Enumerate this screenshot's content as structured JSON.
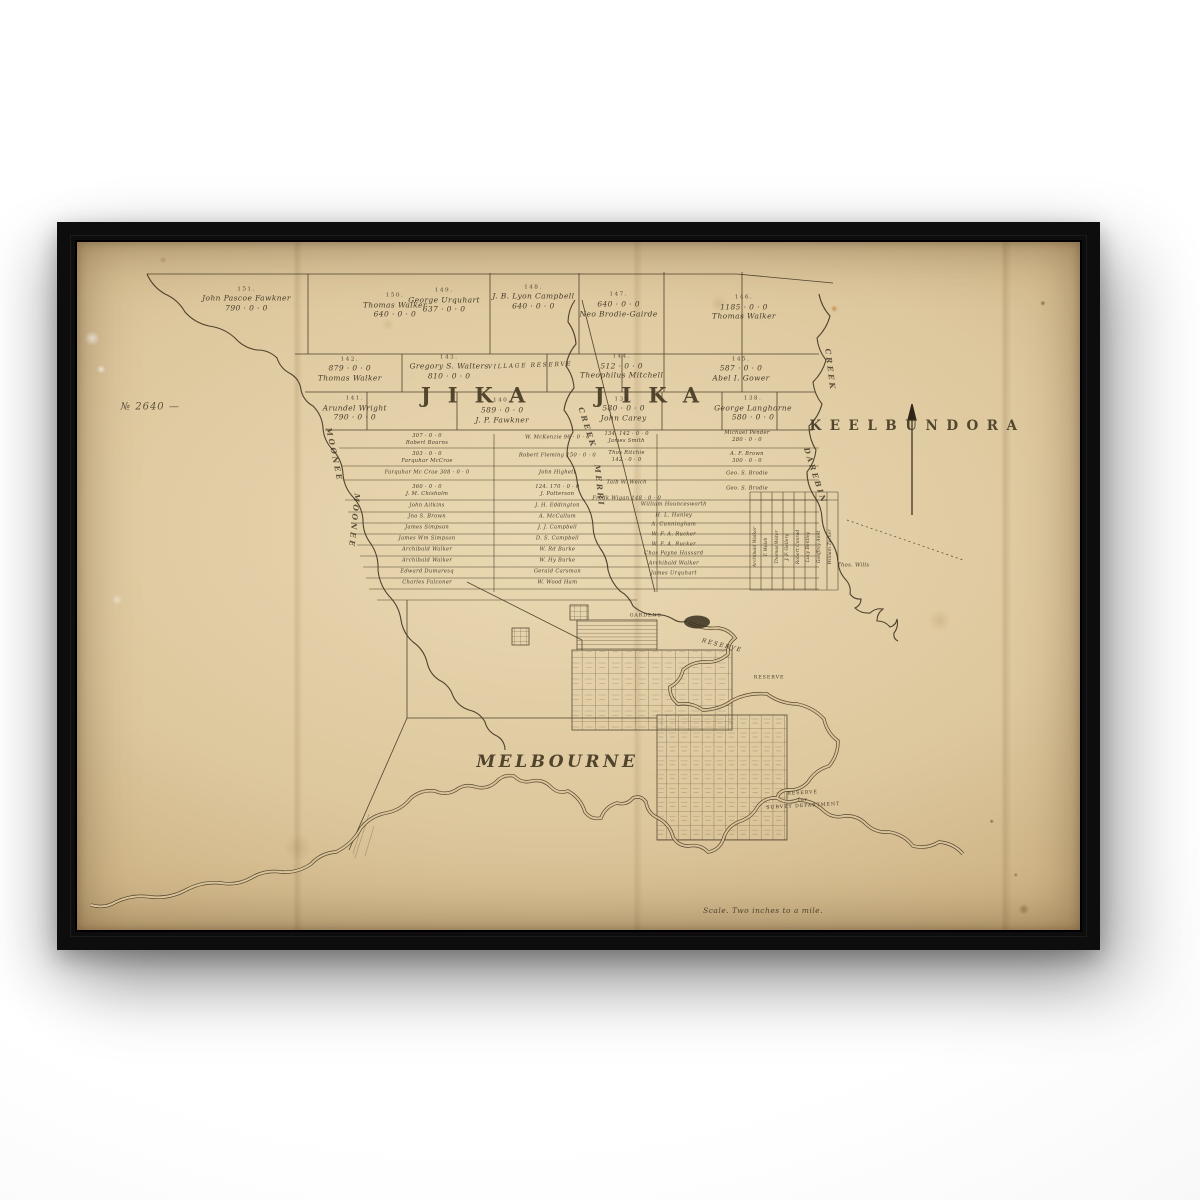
{
  "scene": {
    "background_color": "#ffffff",
    "frame_color": "#0d0d0d",
    "paper_color": "#dcc79d",
    "ink_color": "#3a3120"
  },
  "map": {
    "map_number": "№ 2640 —",
    "parish_title": "JIKA JIKA",
    "adjacent_parish": "KEELBUNDORA",
    "town_label": "MELBOURNE",
    "scale_note": "Scale. Two inches to a mile.",
    "creek_names": [
      "MOONEE MOONEE",
      "MERRI CREEK",
      "DAREBIN CREEK"
    ],
    "labels": [
      {
        "name": "map-number",
        "cls": "manu",
        "x": 7.3,
        "y": 24.0,
        "lines": [
          "№ 2640 —"
        ]
      },
      {
        "name": "parish-title",
        "cls": "parish",
        "x": 49.0,
        "y": 22.3,
        "lines": [
          "JIKA JIKA"
        ]
      },
      {
        "name": "adjacent-parish",
        "cls": "region",
        "x": 83.8,
        "y": 26.9,
        "lines": [
          "KEELBUNDORA"
        ]
      },
      {
        "name": "town-label",
        "cls": "town",
        "x": 47.9,
        "y": 75.6,
        "lines": [
          "MELBOURNE"
        ]
      },
      {
        "name": "scale-note",
        "cls": "script",
        "x": 68.4,
        "y": 97.2,
        "lines": [
          "Scale. Two inches to a mile."
        ]
      },
      {
        "name": "lot-151",
        "cls": "parcel",
        "x": 16.9,
        "y": 8.4,
        "lines": [
          "151.",
          "John Pascoe Fawkner",
          "790 · 0 · 0"
        ]
      },
      {
        "name": "lot-150",
        "cls": "parcel",
        "x": 31.7,
        "y": 9.3,
        "lines": [
          "150.",
          "Thomas Walker",
          "640 · 0 · 0"
        ]
      },
      {
        "name": "lot-149",
        "cls": "parcel",
        "x": 36.6,
        "y": 8.6,
        "lines": [
          "149.",
          "George Urquhart",
          "637 · 0 · 0"
        ]
      },
      {
        "name": "lot-148",
        "cls": "parcel",
        "x": 45.5,
        "y": 8.1,
        "lines": [
          "148.",
          "J. B. Lyon Campbell",
          "640 · 0 · 0"
        ]
      },
      {
        "name": "lot-147",
        "cls": "parcel",
        "x": 54.0,
        "y": 9.2,
        "lines": [
          "147.",
          "640 · 0 · 0",
          "Neo Brodie-Gairde"
        ]
      },
      {
        "name": "lot-146",
        "cls": "parcel",
        "x": 66.5,
        "y": 9.6,
        "lines": [
          "146.",
          "1185 · 0 · 0",
          "Thomas Walker"
        ]
      },
      {
        "name": "lot-142",
        "cls": "parcel",
        "x": 27.2,
        "y": 18.6,
        "lines": [
          "142.",
          "879 · 0 · 0",
          "Thomas Walker"
        ]
      },
      {
        "name": "lot-143",
        "cls": "parcel",
        "x": 37.1,
        "y": 18.3,
        "lines": [
          "143.",
          "Gregory S. Walters",
          "810 · 0 · 0"
        ]
      },
      {
        "name": "village-reserve",
        "cls": "note",
        "x": 45.2,
        "y": 18.0,
        "rot": -2,
        "lines": [
          "VILLAGE RESERVE"
        ]
      },
      {
        "name": "lot-144",
        "cls": "parcel",
        "x": 54.3,
        "y": 18.2,
        "lines": [
          "144.",
          "512 · 0 · 0",
          "Theophilus Mitchell"
        ]
      },
      {
        "name": "lot-145",
        "cls": "parcel",
        "x": 66.2,
        "y": 18.6,
        "lines": [
          "145.",
          "587 · 0 · 0",
          "Abel I. Gower"
        ]
      },
      {
        "name": "lot-141",
        "cls": "parcel",
        "x": 27.7,
        "y": 24.3,
        "lines": [
          "141.",
          "Arundel Wright",
          "790 · 0 · 0"
        ]
      },
      {
        "name": "lot-140",
        "cls": "parcel",
        "x": 42.4,
        "y": 24.6,
        "lines": [
          "140.",
          "589 · 0 · 0",
          "J. P. Fawkner"
        ]
      },
      {
        "name": "lot-139",
        "cls": "parcel",
        "x": 54.5,
        "y": 24.4,
        "lines": [
          "139.",
          "580 · 0 · 0",
          "John Carey"
        ]
      },
      {
        "name": "lot-138",
        "cls": "parcel",
        "x": 67.4,
        "y": 24.3,
        "lines": [
          "138.",
          "George Langhorne",
          "580 · 0 · 0"
        ]
      },
      {
        "name": "strip-parcel",
        "cls": "strip",
        "x": 34.9,
        "y": 28.8,
        "lines": [
          "307 · 0 · 0",
          "Robert Bourns"
        ]
      },
      {
        "name": "strip-parcel",
        "cls": "strip",
        "x": 34.9,
        "y": 31.4,
        "lines": [
          "303 · 0 · 0",
          "Farquhar McCrae"
        ]
      },
      {
        "name": "strip-parcel",
        "cls": "strip",
        "x": 34.9,
        "y": 33.6,
        "lines": [
          "Farquhar Mc Crae  308 · 0 · 0"
        ]
      },
      {
        "name": "strip-parcel",
        "cls": "strip",
        "x": 34.9,
        "y": 36.2,
        "lines": [
          "360 · 0 · 0",
          "J. M. Chisholm"
        ]
      },
      {
        "name": "strip-parcel",
        "cls": "strip",
        "x": 34.9,
        "y": 38.4,
        "lines": [
          "John Aitkins"
        ]
      },
      {
        "name": "strip-parcel",
        "cls": "strip",
        "x": 34.9,
        "y": 40.0,
        "lines": [
          "Jno S. Brown"
        ]
      },
      {
        "name": "strip-parcel",
        "cls": "strip",
        "x": 34.9,
        "y": 41.6,
        "lines": [
          "James Simpson"
        ]
      },
      {
        "name": "strip-parcel",
        "cls": "strip",
        "x": 34.9,
        "y": 43.2,
        "lines": [
          "James Wm Simpson"
        ]
      },
      {
        "name": "strip-parcel",
        "cls": "strip",
        "x": 34.9,
        "y": 44.8,
        "lines": [
          "Archibald Walker"
        ]
      },
      {
        "name": "strip-parcel",
        "cls": "strip",
        "x": 34.9,
        "y": 46.4,
        "lines": [
          "Archibald Walker"
        ]
      },
      {
        "name": "strip-parcel",
        "cls": "strip",
        "x": 34.9,
        "y": 48.0,
        "lines": [
          "Edward Dumaresq"
        ]
      },
      {
        "name": "strip-parcel",
        "cls": "strip",
        "x": 34.9,
        "y": 49.6,
        "lines": [
          "Charles Falconer"
        ]
      },
      {
        "name": "strip-parcel",
        "cls": "strip",
        "x": 47.9,
        "y": 28.5,
        "lines": [
          "W. McKenzie  96 · 0 · 0"
        ]
      },
      {
        "name": "strip-parcel",
        "cls": "strip",
        "x": 47.9,
        "y": 31.1,
        "lines": [
          "Robert Fleming  150 · 0 · 0"
        ]
      },
      {
        "name": "strip-parcel",
        "cls": "strip",
        "x": 47.9,
        "y": 33.6,
        "lines": [
          "John Highett"
        ]
      },
      {
        "name": "strip-parcel",
        "cls": "strip",
        "x": 47.9,
        "y": 36.2,
        "lines": [
          "124.  170 · 0 · 0",
          "J. Patterson"
        ]
      },
      {
        "name": "strip-parcel",
        "cls": "strip",
        "x": 47.9,
        "y": 38.4,
        "lines": [
          "J. H. Eddington"
        ]
      },
      {
        "name": "strip-parcel",
        "cls": "strip",
        "x": 47.9,
        "y": 40.0,
        "lines": [
          "A. McCallum"
        ]
      },
      {
        "name": "strip-parcel",
        "cls": "strip",
        "x": 47.9,
        "y": 41.6,
        "lines": [
          "J. J. Campbell"
        ]
      },
      {
        "name": "strip-parcel",
        "cls": "strip",
        "x": 47.9,
        "y": 43.2,
        "lines": [
          "D. S. Campbell"
        ]
      },
      {
        "name": "strip-parcel",
        "cls": "strip",
        "x": 47.9,
        "y": 44.8,
        "lines": [
          "W. Rd Burke"
        ]
      },
      {
        "name": "strip-parcel",
        "cls": "strip",
        "x": 47.9,
        "y": 46.4,
        "lines": [
          "W. Hy Burke"
        ]
      },
      {
        "name": "strip-parcel",
        "cls": "strip",
        "x": 47.9,
        "y": 48.0,
        "lines": [
          "Gerald Carsman"
        ]
      },
      {
        "name": "strip-parcel",
        "cls": "strip",
        "x": 47.9,
        "y": 49.6,
        "lines": [
          "W. Wood Ham"
        ]
      },
      {
        "name": "strip-parcel",
        "cls": "strip",
        "x": 54.8,
        "y": 28.5,
        "lines": [
          "134.  142 · 0 · 0",
          "James Smith"
        ]
      },
      {
        "name": "strip-parcel",
        "cls": "strip",
        "x": 54.8,
        "y": 31.2,
        "lines": [
          "Thos Ritchie",
          "142 · 0 · 0"
        ]
      },
      {
        "name": "strip-parcel",
        "cls": "strip",
        "x": 54.8,
        "y": 35.0,
        "lines": [
          "Talb W. Welch"
        ]
      },
      {
        "name": "strip-parcel",
        "cls": "strip",
        "x": 54.8,
        "y": 37.3,
        "lines": [
          "Fredk Wigan  148 · 0 · 0"
        ]
      },
      {
        "name": "strip-parcel",
        "cls": "strip",
        "x": 59.5,
        "y": 38.2,
        "lines": [
          "William Houncesworth"
        ]
      },
      {
        "name": "strip-parcel",
        "cls": "strip",
        "x": 59.5,
        "y": 39.8,
        "lines": [
          "H. L. Hanley"
        ]
      },
      {
        "name": "strip-parcel",
        "cls": "strip",
        "x": 59.5,
        "y": 41.2,
        "lines": [
          "A. Cunningham"
        ]
      },
      {
        "name": "strip-parcel",
        "cls": "strip",
        "x": 59.5,
        "y": 42.6,
        "lines": [
          "W. F. A. Rucker"
        ]
      },
      {
        "name": "strip-parcel",
        "cls": "strip",
        "x": 59.5,
        "y": 44.0,
        "lines": [
          "W. F. A. Rucker"
        ]
      },
      {
        "name": "strip-parcel",
        "cls": "strip",
        "x": 59.5,
        "y": 45.4,
        "lines": [
          "Chas Payne Hassard"
        ]
      },
      {
        "name": "strip-parcel",
        "cls": "strip",
        "x": 59.5,
        "y": 46.8,
        "lines": [
          "Archibald Walker"
        ]
      },
      {
        "name": "strip-parcel",
        "cls": "strip",
        "x": 59.5,
        "y": 48.2,
        "lines": [
          "James Urquhart"
        ]
      },
      {
        "name": "strip-parcel",
        "cls": "strip",
        "x": 66.8,
        "y": 28.3,
        "lines": [
          "Michael Pender",
          "280 · 0 · 0"
        ]
      },
      {
        "name": "strip-parcel",
        "cls": "strip",
        "x": 66.8,
        "y": 31.4,
        "lines": [
          "A. F. Brown",
          "300 · 0 · 0"
        ]
      },
      {
        "name": "strip-parcel",
        "cls": "strip",
        "x": 66.8,
        "y": 33.7,
        "lines": [
          "Geo. S. Brodie"
        ]
      },
      {
        "name": "strip-parcel",
        "cls": "strip",
        "x": 66.8,
        "y": 35.9,
        "lines": [
          "Geo. S. Brodie"
        ]
      },
      {
        "name": "strip-parcel",
        "cls": "vstrip",
        "x": 67.7,
        "y": 44.3,
        "rot": -90,
        "lines": [
          "Archibald Walker"
        ]
      },
      {
        "name": "strip-parcel",
        "cls": "vstrip",
        "x": 68.8,
        "y": 44.3,
        "rot": -90,
        "lines": [
          "T. Walsh"
        ]
      },
      {
        "name": "strip-parcel",
        "cls": "vstrip",
        "x": 69.9,
        "y": 44.3,
        "rot": -90,
        "lines": [
          "Thomas Water"
        ]
      },
      {
        "name": "strip-parcel",
        "cls": "vstrip",
        "x": 70.9,
        "y": 44.3,
        "rot": -90,
        "lines": [
          "J. F. Gellery"
        ]
      },
      {
        "name": "strip-parcel",
        "cls": "vstrip",
        "x": 72.0,
        "y": 44.3,
        "rot": -90,
        "lines": [
          "Robert Conrad"
        ]
      },
      {
        "name": "strip-parcel",
        "cls": "vstrip",
        "x": 73.0,
        "y": 44.3,
        "rot": -90,
        "lines": [
          "Lucy Bentley"
        ]
      },
      {
        "name": "strip-parcel",
        "cls": "vstrip",
        "x": 74.1,
        "y": 44.3,
        "rot": -90,
        "lines": [
          "Geoffrey Amit"
        ]
      },
      {
        "name": "strip-parcel",
        "cls": "vstrip",
        "x": 75.2,
        "y": 44.3,
        "rot": -90,
        "lines": [
          "William Turner"
        ]
      },
      {
        "name": "strip-parcel",
        "cls": "strip",
        "x": 77.4,
        "y": 47.1,
        "lines": [
          "Thos. Wills"
        ]
      },
      {
        "name": "gardens-label",
        "cls": "tiny",
        "x": 56.7,
        "y": 54.5,
        "lines": [
          "GARDENS"
        ]
      },
      {
        "name": "reserve-label",
        "cls": "note",
        "x": 64.3,
        "y": 58.7,
        "rot": 14,
        "lines": [
          "RESERVE"
        ]
      },
      {
        "name": "reserve-label",
        "cls": "tiny",
        "x": 69.0,
        "y": 63.5,
        "lines": [
          "RESERVE"
        ]
      },
      {
        "name": "survey-reserve-label",
        "cls": "tiny",
        "x": 72.4,
        "y": 81.2,
        "rot": -3,
        "lines": [
          "RESERVE",
          "for",
          "SURVEY DEPARTMENT"
        ]
      },
      {
        "name": "creek-label",
        "cls": "creek",
        "x": 25.6,
        "y": 31.0,
        "rot": 78,
        "lines": [
          "MOONEE"
        ]
      },
      {
        "name": "creek-label",
        "cls": "creek",
        "x": 27.6,
        "y": 40.5,
        "rot": 96,
        "lines": [
          "MOONEE"
        ]
      },
      {
        "name": "creek-label",
        "cls": "creek",
        "x": 50.8,
        "y": 27.0,
        "rot": 72,
        "lines": [
          "CREEK"
        ]
      },
      {
        "name": "creek-label",
        "cls": "creek",
        "x": 52.0,
        "y": 35.5,
        "rot": 84,
        "lines": [
          "MERRI"
        ]
      },
      {
        "name": "creek-label",
        "cls": "creek",
        "x": 75.1,
        "y": 18.6,
        "rot": 83,
        "lines": [
          "CREEK"
        ]
      },
      {
        "name": "creek-label",
        "cls": "creek",
        "x": 73.6,
        "y": 34.0,
        "rot": 72,
        "lines": [
          "DAREBIN"
        ]
      }
    ]
  }
}
